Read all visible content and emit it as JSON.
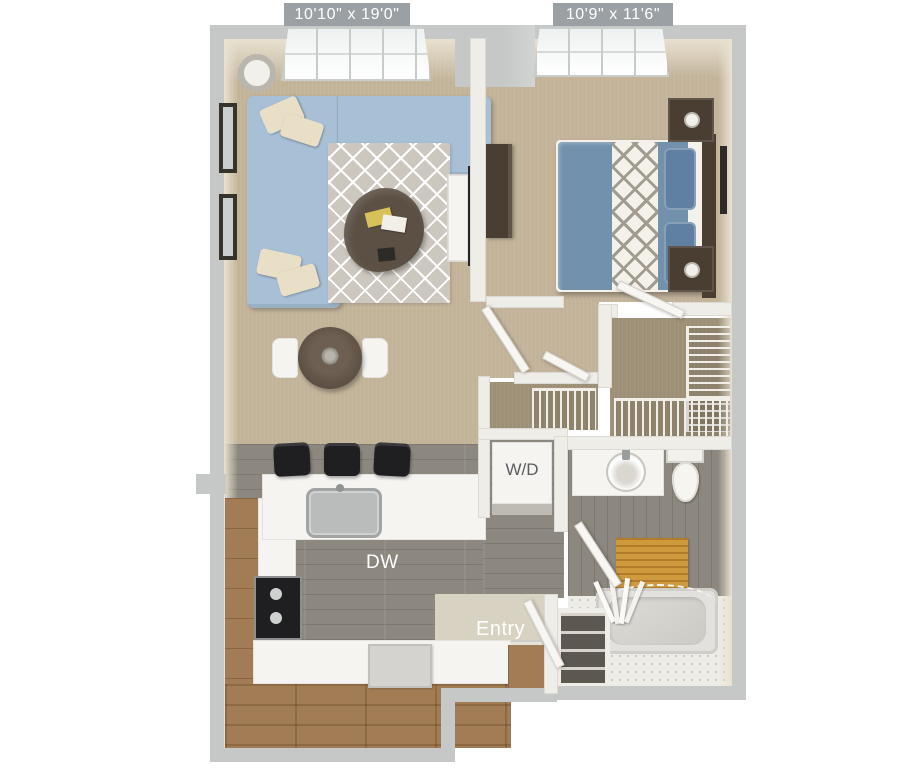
{
  "title": "One bedroom apartment floor plan",
  "rooms": {
    "living": {
      "dimensions": "10'10\" x 19'0\""
    },
    "bedroom": {
      "dimensions": "10'9\" x 11'6\""
    }
  },
  "labels": {
    "washer_dryer": "W/D",
    "dishwasher": "DW",
    "entry": "Entry"
  },
  "icons": [
    "sofa",
    "area-rug",
    "coffee-table",
    "floor-lamp",
    "tv",
    "dining-table",
    "bar-stool",
    "kitchen-sink",
    "stove",
    "refrigerator",
    "bed",
    "nightstand",
    "dresser",
    "wire-shelf",
    "bathroom-sink",
    "toilet",
    "bathtub",
    "shower-curtain",
    "bath-mat",
    "door",
    "window"
  ],
  "palette": {
    "background": "#ffffff",
    "wall": "#c6c8c7",
    "wall_inner": "#efede8",
    "wall_face": "#e9e2d1",
    "badge": "#9aa0a3",
    "badge_text": "#ffffff",
    "carpet": "#c2b399",
    "carpet_dark": "#9d9077",
    "wood_floor": "#8d887f",
    "cabinet_wood": "#a27c54",
    "counter": "#f5f4f1",
    "sofa": "#a7c0d6",
    "pillow": "#e9dfc6",
    "rug": "#ccc7bf",
    "table_dark": "#5c5044",
    "bed_blanket": "#7191ad",
    "furniture_dark": "#4a3e33",
    "bath_mat": "#cf9a3d",
    "tile": "#edece6",
    "appliance_black": "#1f1f22",
    "appliance_gray": "#d4d3cf",
    "label_text": "#ffffff",
    "wd_text": "#5a5e60"
  }
}
